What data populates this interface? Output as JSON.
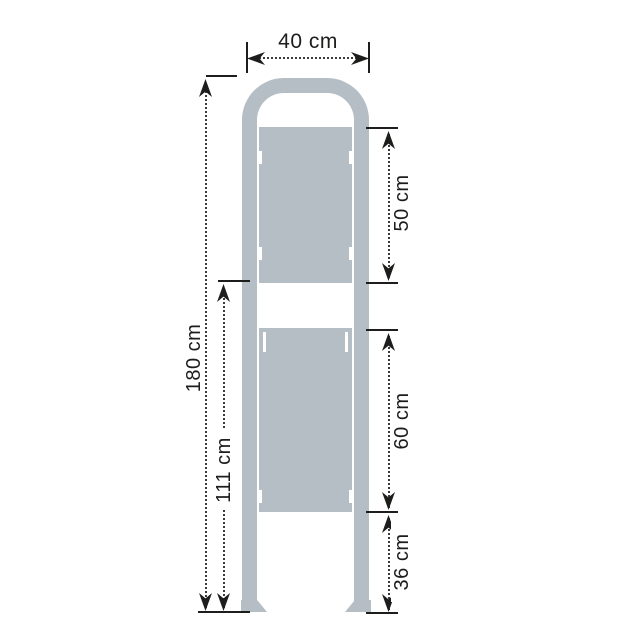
{
  "diagram": {
    "object": "two-panel-display-stand-front-view",
    "unit": "cm",
    "dimensions": {
      "frame_width": {
        "label": "40 cm",
        "value": 40
      },
      "total_height": {
        "label": "180 cm",
        "value": 180
      },
      "upper_panel_bottom_height": {
        "label": "111 cm",
        "value": 111
      },
      "upper_panel_height": {
        "label": "50 cm",
        "value": 50
      },
      "lower_panel_height": {
        "label": "60 cm",
        "value": 60
      },
      "ground_clearance": {
        "label": "36 cm",
        "value": 36
      }
    },
    "colors": {
      "structure": "#b5bec5",
      "dimension_lines": "#1d1d1b",
      "background": "#ffffff"
    }
  }
}
